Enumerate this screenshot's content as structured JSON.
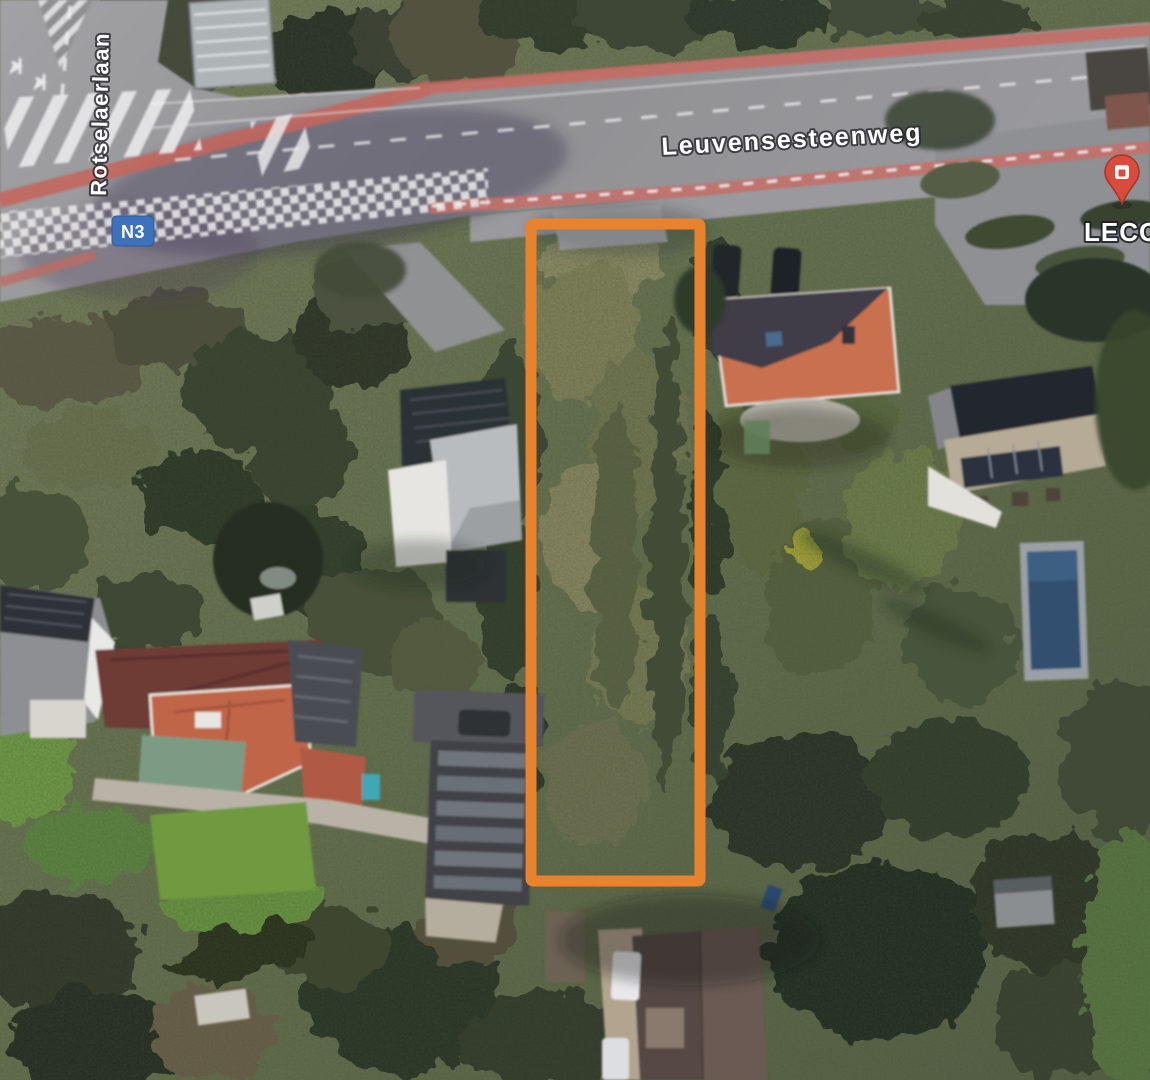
{
  "map": {
    "view_type": "satellite-aerial",
    "labels": {
      "main_road": "Leuvensesteenweg",
      "side_road": "Rotselaerlaan"
    },
    "route_badge": {
      "text": "N3",
      "color": "#3E71BC"
    },
    "poi": {
      "label": "LECOT",
      "pin_color": "#D94B3B",
      "icon": "store-pin-icon"
    },
    "parcel_outline": {
      "shape": "rectangle",
      "color": "#E9822D"
    }
  }
}
